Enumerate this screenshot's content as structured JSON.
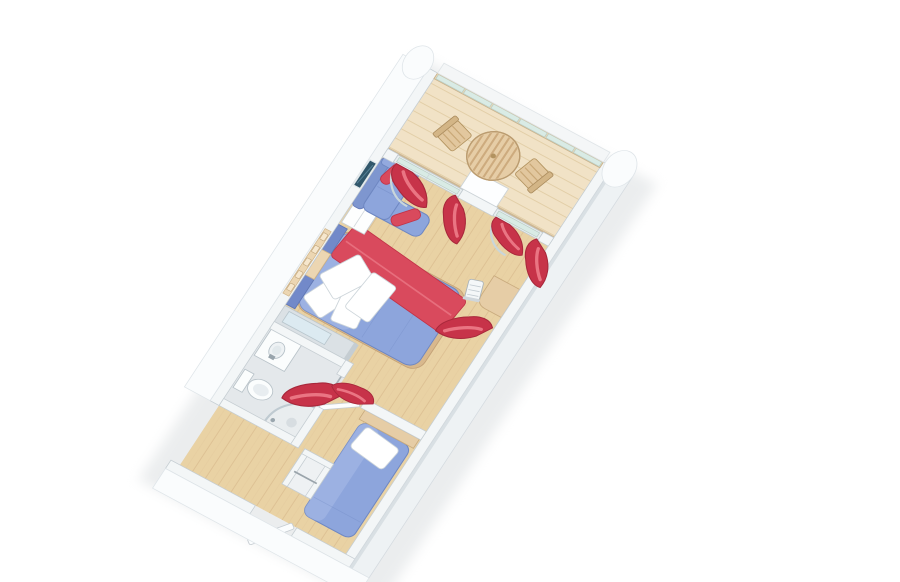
{
  "palette": {
    "background": "#ffffff",
    "wall": "#f3f6f7",
    "wall_edge": "#c5cdd2",
    "wall_face": "#fafcfd",
    "wood_floor": "#e9d2a4",
    "wood_floor_grain": "#dcbf92",
    "balcony_deck": "#f1e2c6",
    "bathroom_floor": "#e4e8eb",
    "upholstery_blue": "#8da5dc",
    "upholstery_blue_dark": "#6e87c2",
    "upholstery_blue_light": "#a9bce8",
    "accent_red": "#d94a5d",
    "curtain_red": "#c73349",
    "wood_tan": "#e6cda6",
    "railing_glass": "#d9ebe5",
    "linen_white": "#ffffff",
    "tv_screen": "#31576b"
  },
  "scene": {
    "description": "Rotated axonometric 3D floor plan illustration of a cruise-ship balcony stateroom, long axis pointing to the upper right, on a plain white background",
    "rooms": [
      {
        "id": "balcony",
        "floor": "light wood deck",
        "furniture": [
          "glass-railing",
          "round-slatted-table",
          "deck-chair",
          "deck-chair",
          "divider-side-table"
        ]
      },
      {
        "id": "living-area",
        "floor": "wood",
        "furniture": [
          "sofa-with-chaise",
          "red-bolster-pillow",
          "red-bolster-pillow",
          "wall-tv",
          "sliding-glass-door",
          "sliding-glass-door",
          "red-curtains"
        ]
      },
      {
        "id": "bedroom",
        "floor": "wood",
        "furniture": [
          "queen-bed",
          "white-pillows",
          "red-bed-runner",
          "headboard",
          "reading-lamp-strip",
          "nightstand",
          "vanity-desk",
          "desk-chair",
          "wardrobe-with-mirror"
        ]
      },
      {
        "id": "bathroom",
        "floor": "grey tile",
        "furniture": [
          "sink-vanity",
          "mirror",
          "toilet",
          "curved-glass-shower",
          "towel-bar",
          "bathroom-door"
        ]
      },
      {
        "id": "second-sleeping-area",
        "floor": "wood",
        "furniture": [
          "single-bed",
          "white-pillow",
          "headboard-panel",
          "privacy-curtain",
          "shelf-niche"
        ]
      },
      {
        "id": "entry",
        "floor": "wood",
        "furniture": [
          "entry-door-open"
        ]
      }
    ],
    "curtain_count": 7,
    "railing_glass_panels": 6
  }
}
